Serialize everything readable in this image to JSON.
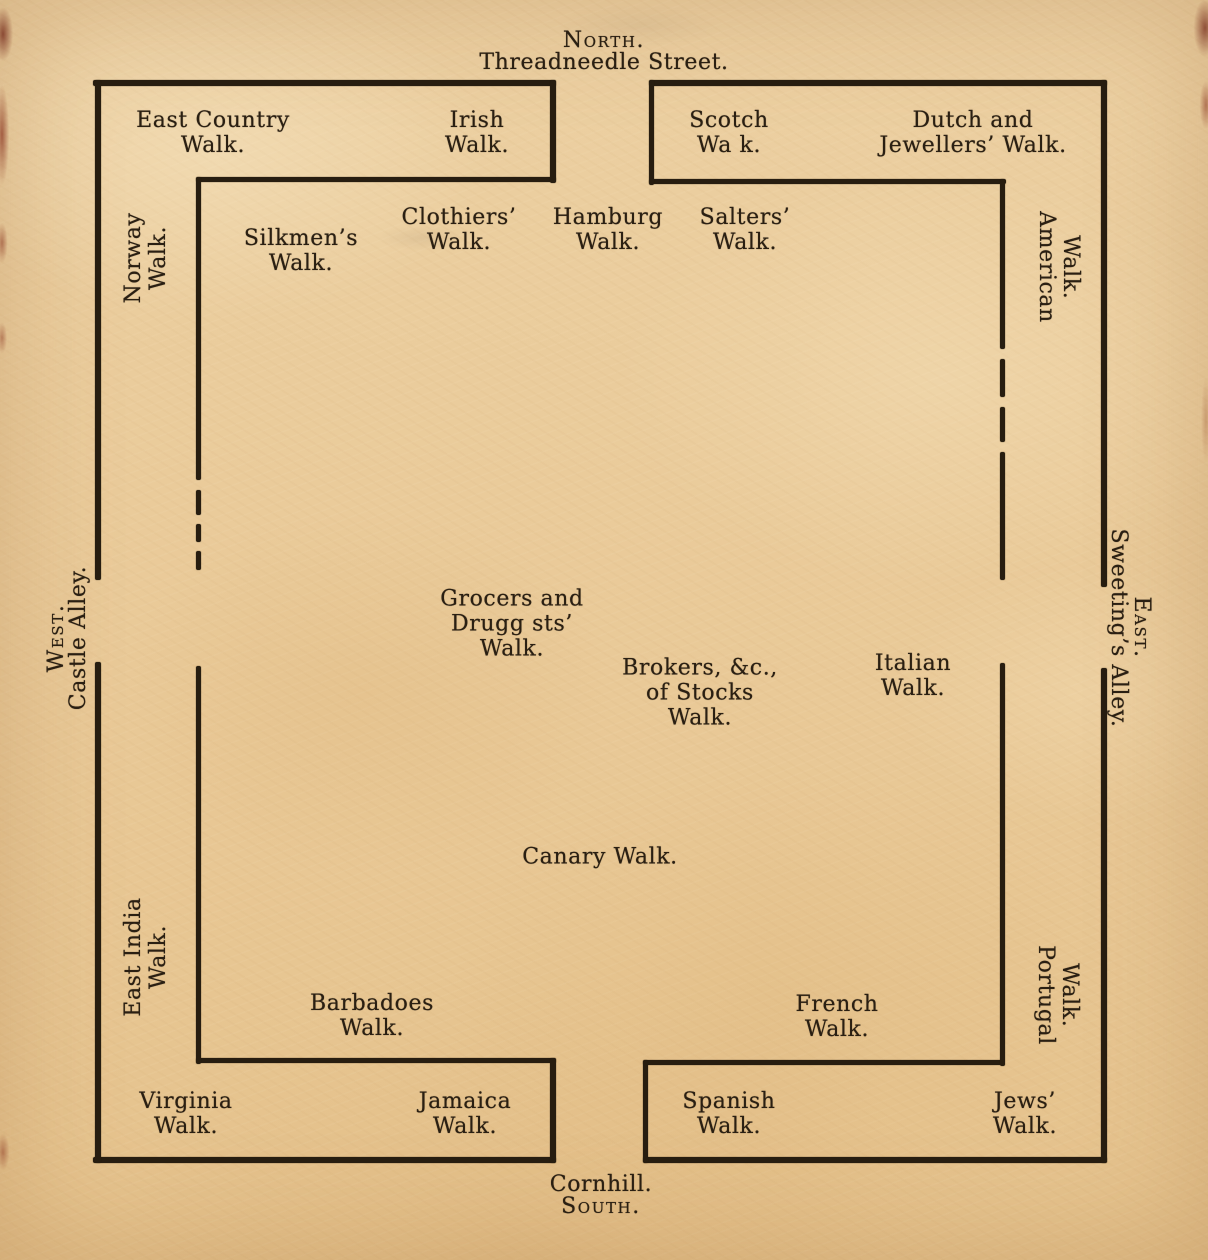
{
  "plan": {
    "compass": {
      "north": {
        "direction": "North.",
        "street": "Threadneedle Street."
      },
      "south": {
        "street": "Cornhill.",
        "direction": "South."
      },
      "west": {
        "direction": "West.",
        "street": "Castle Alley."
      },
      "east": {
        "direction": "East.",
        "street": "Sweeting’s Alley."
      }
    },
    "walks": {
      "east_country": "East Country\nWalk.",
      "irish": "Irish\nWalk.",
      "scotch": "Scotch\nWa k.",
      "dutch_jewellers": "Dutch and\nJewellers’ Walk.",
      "norway": "Norway\nWalk.",
      "silkmens": "Silkmen’s\nWalk.",
      "clothiers": "Clothiers’\nWalk.",
      "hamburg": "Hamburg\nWalk.",
      "salters": "Salters’\nWalk.",
      "american": "American\nWalk.",
      "grocers_druggists": "Grocers and\nDrugg sts’\nWalk.",
      "brokers_of_stocks": "Brokers, &c.,\nof Stocks\nWalk.",
      "italian": "Italian\nWalk.",
      "canary": "Canary Walk.",
      "east_india": "East India\nWalk.",
      "portugal": "Portugal\nWalk.",
      "barbadoes": "Barbadoes\nWalk.",
      "french": "French\nWalk.",
      "virginia": "Virginia\nWalk.",
      "jamaica": "Jamaica\nWalk.",
      "spanish": "Spanish\nWalk.",
      "jews": "Jews’\nWalk."
    }
  }
}
